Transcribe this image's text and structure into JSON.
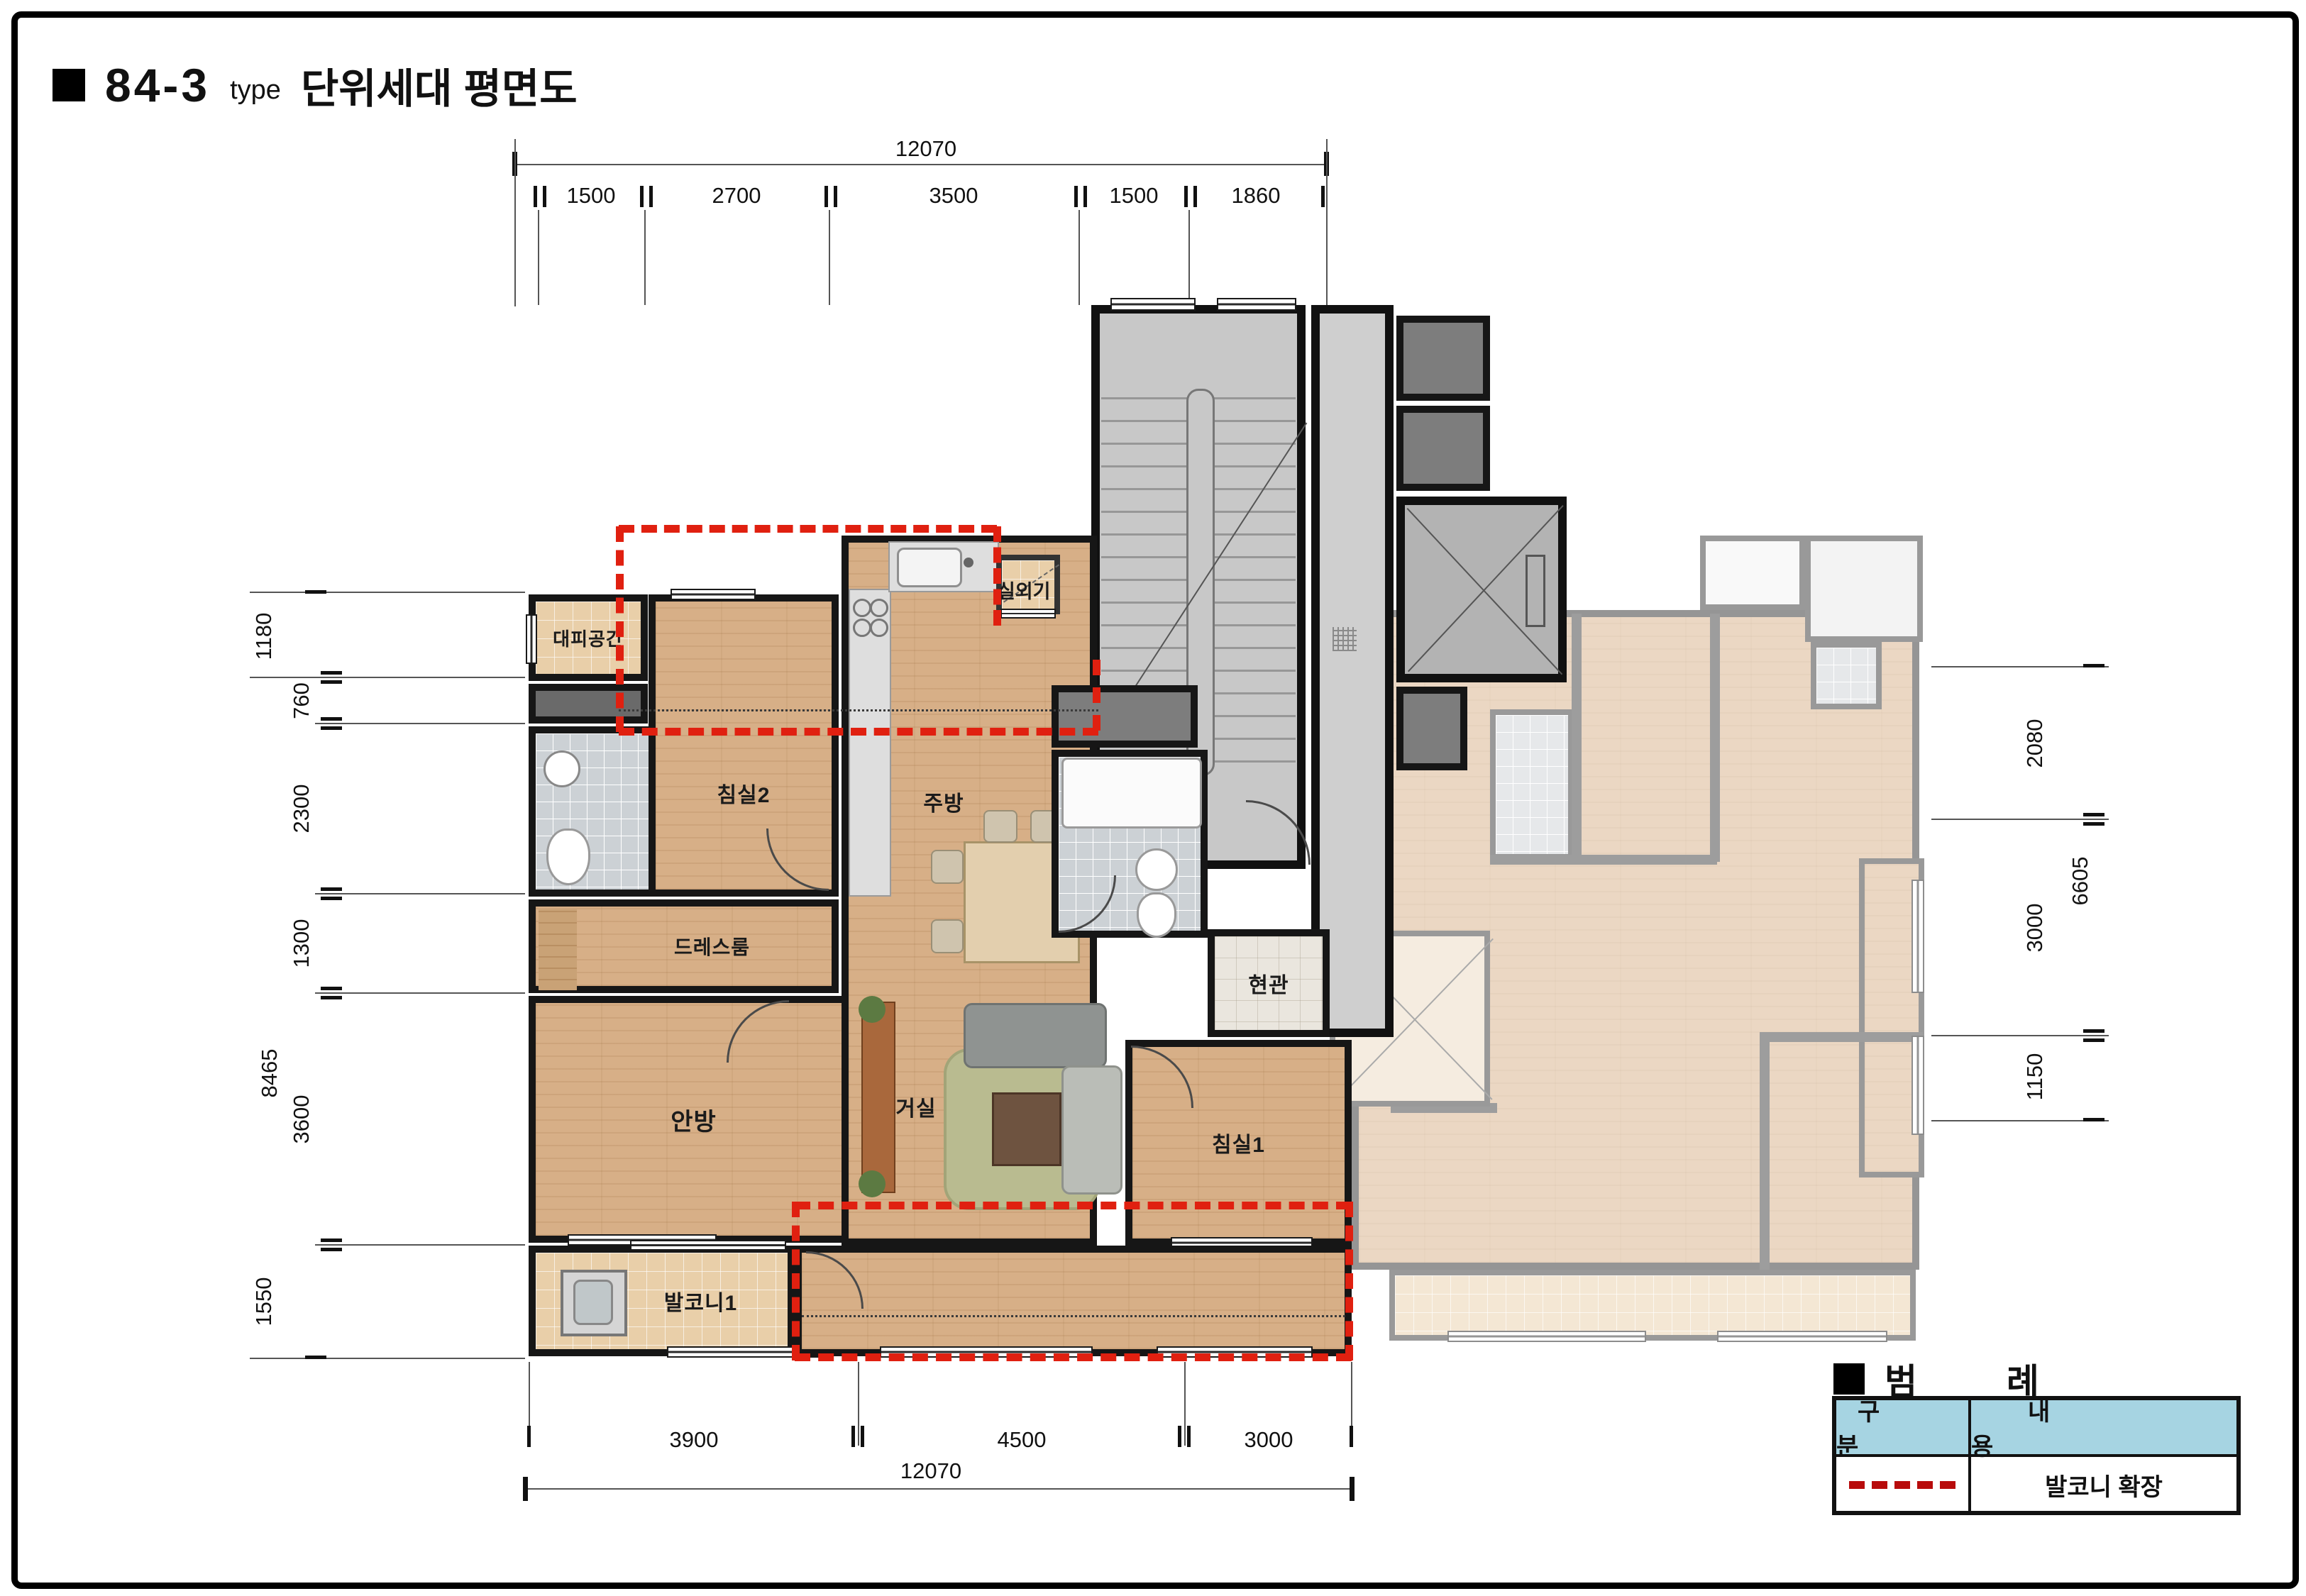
{
  "title": {
    "bullet": "■",
    "code": "84-3",
    "type_label": "type",
    "name": "단위세대 평면도"
  },
  "dimensions": {
    "top": {
      "overall": "12070",
      "segments": [
        "1500",
        "2700",
        "3500",
        "1500",
        "1860"
      ]
    },
    "bottom": {
      "overall": "12070",
      "segments": [
        "3900",
        "4500",
        "3000"
      ]
    },
    "left": {
      "overall": "8465",
      "segments": [
        "1180",
        "760",
        "2300",
        "1300",
        "3600",
        "1550"
      ]
    },
    "right": {
      "overall": "6605",
      "segments": [
        "2080",
        "3000",
        "1150"
      ]
    }
  },
  "rooms": {
    "refuge": "대피공간",
    "bedroom2": "침실2",
    "kitchen": "주방",
    "outdoor_unit": "실외기",
    "dressroom": "드레스룸",
    "entrance": "현관",
    "master": "안방",
    "living": "거실",
    "bedroom1": "침실1",
    "balcony1": "발코니1"
  },
  "legend": {
    "bullet": "■",
    "title": "범  례",
    "col_category": "구  분",
    "col_content": "내  용",
    "row_content": "발코니 확장"
  },
  "colors": {
    "balcony_expansion_dash": "#e02010",
    "legend_dash": "#b80c0c",
    "legend_header_bg": "#a6d4e2",
    "wall": "#161616",
    "wood_floor": "#d7af87",
    "stair_core": "#c8c8c8"
  }
}
